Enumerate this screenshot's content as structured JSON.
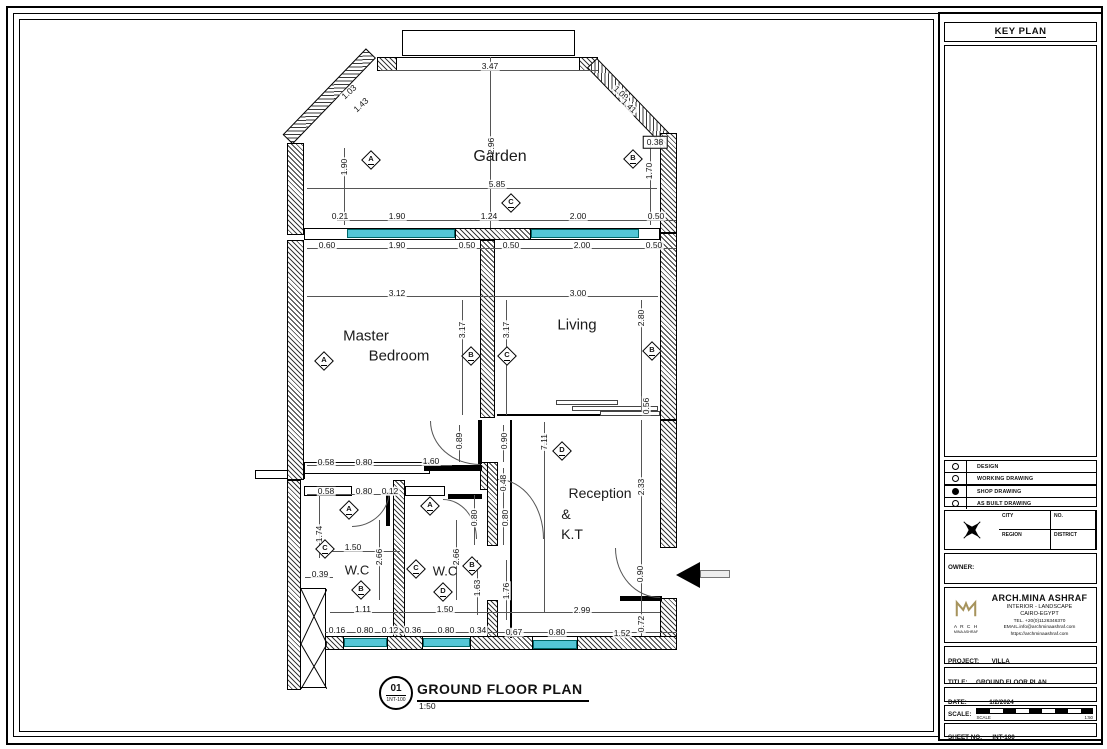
{
  "colors": {
    "window": "#53c6d6",
    "logo": "#a6935c"
  },
  "drawing_title": {
    "number": "01",
    "sheet_ref": "1NT-100",
    "title": "GROUND FLOOR PLAN",
    "scale": "1:50"
  },
  "rooms": [
    {
      "t": "Garden",
      "x": 500,
      "y": 157,
      "s": 16
    },
    {
      "t": "Master",
      "x": 366,
      "y": 336,
      "s": 15
    },
    {
      "t": "Bedroom",
      "x": 399,
      "y": 356,
      "s": 15
    },
    {
      "t": "Living",
      "x": 577,
      "y": 325,
      "s": 15
    },
    {
      "t": "Reception",
      "x": 600,
      "y": 493,
      "s": 14
    },
    {
      "t": "&",
      "x": 566,
      "y": 514,
      "s": 14
    },
    {
      "t": "K.T",
      "x": 572,
      "y": 534,
      "s": 14
    },
    {
      "t": "W.C",
      "x": 357,
      "y": 570,
      "s": 13
    },
    {
      "t": "W.C",
      "x": 445,
      "y": 571,
      "s": 13
    }
  ],
  "dims": [
    {
      "t": "3.47",
      "x": 490,
      "y": 66
    },
    {
      "t": "1.03",
      "x": 349,
      "y": 92,
      "r": -42
    },
    {
      "t": "1.43",
      "x": 361,
      "y": 105,
      "r": -42
    },
    {
      "t": "1.09",
      "x": 621,
      "y": 93,
      "r": 42
    },
    {
      "t": "1.41",
      "x": 629,
      "y": 106,
      "r": 42
    },
    {
      "t": "1.90",
      "x": 344,
      "y": 167,
      "r": -90
    },
    {
      "t": "2.96",
      "x": 491,
      "y": 146,
      "r": -90
    },
    {
      "t": "1.70",
      "x": 649,
      "y": 171,
      "r": -90
    },
    {
      "t": "5.85",
      "x": 497,
      "y": 184
    },
    {
      "t": "0.38",
      "x": 655,
      "y": 142,
      "box": true
    },
    {
      "t": "0.21",
      "x": 340,
      "y": 216
    },
    {
      "t": "1.90",
      "x": 397,
      "y": 216
    },
    {
      "t": "1.24",
      "x": 489,
      "y": 216
    },
    {
      "t": "2.00",
      "x": 578,
      "y": 216
    },
    {
      "t": "0.50",
      "x": 656,
      "y": 216
    },
    {
      "t": "0.60",
      "x": 327,
      "y": 245
    },
    {
      "t": "1.90",
      "x": 397,
      "y": 245
    },
    {
      "t": "0.50",
      "x": 467,
      "y": 245
    },
    {
      "t": "0.50",
      "x": 511,
      "y": 245
    },
    {
      "t": "2.00",
      "x": 582,
      "y": 245
    },
    {
      "t": "0.50",
      "x": 654,
      "y": 245
    },
    {
      "t": "3.12",
      "x": 397,
      "y": 293
    },
    {
      "t": "3.00",
      "x": 578,
      "y": 293
    },
    {
      "t": "3.17",
      "x": 462,
      "y": 330,
      "r": -90
    },
    {
      "t": "3.17",
      "x": 506,
      "y": 330,
      "r": -90
    },
    {
      "t": "2.80",
      "x": 641,
      "y": 318,
      "r": -90
    },
    {
      "t": "0.56",
      "x": 646,
      "y": 406,
      "r": -90
    },
    {
      "t": "7.11",
      "x": 544,
      "y": 442,
      "r": -90
    },
    {
      "t": "2.33",
      "x": 641,
      "y": 487,
      "r": -90
    },
    {
      "t": "0.89",
      "x": 459,
      "y": 441,
      "r": -90
    },
    {
      "t": "0.90",
      "x": 504,
      "y": 441,
      "r": -90
    },
    {
      "t": "1.60",
      "x": 431,
      "y": 461
    },
    {
      "t": "0.58",
      "x": 326,
      "y": 462
    },
    {
      "t": "0.80",
      "x": 364,
      "y": 462
    },
    {
      "t": "0.58",
      "x": 326,
      "y": 491
    },
    {
      "t": "0.80",
      "x": 364,
      "y": 491
    },
    {
      "t": "0.12",
      "x": 390,
      "y": 491
    },
    {
      "t": "0.48",
      "x": 503,
      "y": 483,
      "r": -90
    },
    {
      "t": "0.80",
      "x": 474,
      "y": 518,
      "r": -90
    },
    {
      "t": "0.80",
      "x": 505,
      "y": 518,
      "r": -90
    },
    {
      "t": "1.74",
      "x": 319,
      "y": 534,
      "r": -90
    },
    {
      "t": "1.50",
      "x": 353,
      "y": 547
    },
    {
      "t": "2.66",
      "x": 379,
      "y": 557,
      "r": -90
    },
    {
      "t": "0.39",
      "x": 320,
      "y": 574
    },
    {
      "t": "2.66",
      "x": 456,
      "y": 557,
      "r": -90
    },
    {
      "t": "1.63",
      "x": 477,
      "y": 588,
      "r": -90
    },
    {
      "t": "1.76",
      "x": 506,
      "y": 591,
      "r": -90
    },
    {
      "t": "1.11",
      "x": 363,
      "y": 609
    },
    {
      "t": "1.50",
      "x": 445,
      "y": 609
    },
    {
      "t": "2.99",
      "x": 582,
      "y": 610
    },
    {
      "t": "0.90",
      "x": 640,
      "y": 574,
      "r": -90
    },
    {
      "t": "0.72",
      "x": 641,
      "y": 624,
      "r": -90
    },
    {
      "t": "0.16",
      "x": 337,
      "y": 630
    },
    {
      "t": "0.80",
      "x": 365,
      "y": 630
    },
    {
      "t": "0.12",
      "x": 390,
      "y": 630
    },
    {
      "t": "0.36",
      "x": 413,
      "y": 630
    },
    {
      "t": "0.80",
      "x": 446,
      "y": 630
    },
    {
      "t": "0.34",
      "x": 478,
      "y": 630
    },
    {
      "t": "0.67",
      "x": 514,
      "y": 632
    },
    {
      "t": "0.80",
      "x": 557,
      "y": 632
    },
    {
      "t": "1.52",
      "x": 622,
      "y": 633
    }
  ],
  "markers": [
    {
      "l": "A",
      "x": 371,
      "y": 160
    },
    {
      "l": "B",
      "x": 633,
      "y": 159
    },
    {
      "l": "C",
      "x": 511,
      "y": 203
    },
    {
      "l": "A",
      "x": 324,
      "y": 361
    },
    {
      "l": "B",
      "x": 471,
      "y": 356
    },
    {
      "l": "C",
      "x": 507,
      "y": 356
    },
    {
      "l": "B",
      "x": 652,
      "y": 351
    },
    {
      "l": "D",
      "x": 562,
      "y": 451
    },
    {
      "l": "A",
      "x": 349,
      "y": 510
    },
    {
      "l": "C",
      "x": 325,
      "y": 549
    },
    {
      "l": "B",
      "x": 361,
      "y": 590
    },
    {
      "l": "A",
      "x": 430,
      "y": 506
    },
    {
      "l": "C",
      "x": 416,
      "y": 569
    },
    {
      "l": "B",
      "x": 472,
      "y": 566
    },
    {
      "l": "D",
      "x": 443,
      "y": 592
    }
  ],
  "panel": {
    "key_plan_title": "KEY PLAN",
    "legend": [
      {
        "label": "DESIGN",
        "filled": false
      },
      {
        "label": "WORKING DRAWING",
        "filled": false
      },
      {
        "label": "SHOP DRAWING",
        "filled": true
      },
      {
        "label": "AS BUILT DRAWING",
        "filled": false
      }
    ],
    "region_table": {
      "city": "CITY",
      "no": "NO.",
      "region": "REGION",
      "district": "DISTRICT"
    },
    "owner_label": "OWNER:",
    "architect": {
      "name": "ARCH.MINA ASHRAF",
      "field": "INTERIOR - LANDSCAPE",
      "city": "CAIRO-EGYPT",
      "tel": "TEL.  +20(0)1126346370",
      "email": "EMAIL.info@archminaashraf.com",
      "web": "https://archminaashraf.com",
      "logo_sub1": "A R C H",
      "logo_sub2": "MINA ASHRAF"
    },
    "project_label": "PROJECT:",
    "project_value": "VILLA",
    "title_label": "TITLE:",
    "title_value": "GROUND FLOOR PLAN",
    "date_label": "DATE:",
    "date_value": "1/2/2024",
    "scale_label": "SCALE:",
    "scale_sub_left": "SCALE",
    "scale_sub_right": "1:50",
    "sheet_label": "SHEET NO.",
    "sheet_value": "INT-100"
  }
}
